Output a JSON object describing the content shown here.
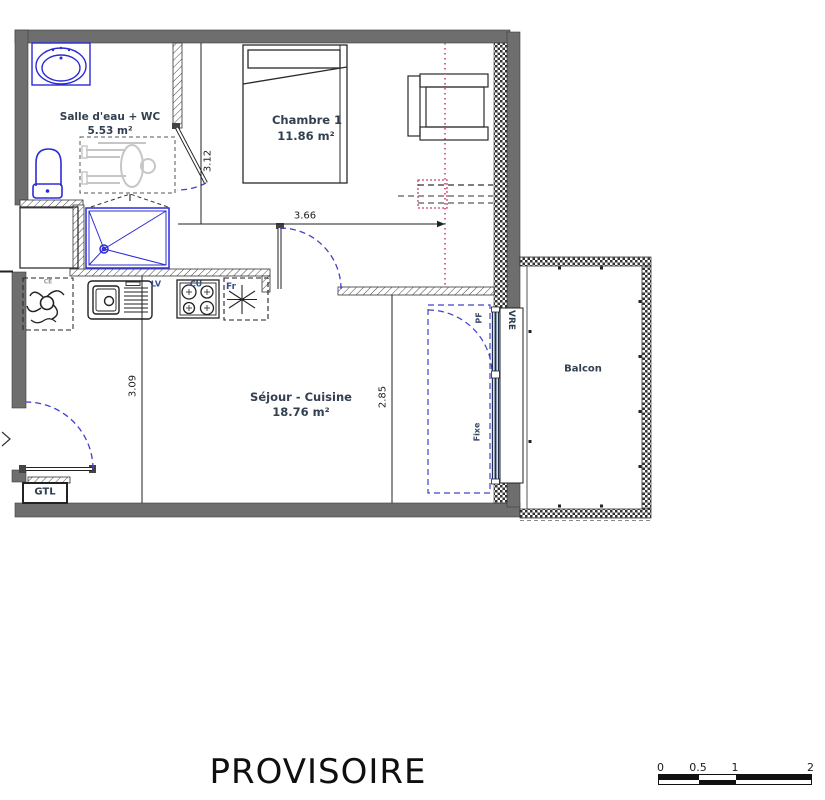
{
  "colors": {
    "wall_gray": "#6e6e6e",
    "fixture_blue": "#2b2bd5",
    "door_arc_blue": "#4040cc",
    "section_red": "#c2486a",
    "room_label": "#32404f",
    "appliance_label_blue": "#33508c"
  },
  "rooms": {
    "bathroom": {
      "name": "Salle d'eau + WC",
      "area": "5.53 m²"
    },
    "bedroom": {
      "name": "Chambre 1",
      "area": "11.86 m²"
    },
    "living": {
      "name": "Séjour - Cuisine",
      "area": "18.76 m²"
    },
    "balcony": {
      "name": "Balcon"
    }
  },
  "dimensions": {
    "bathroom_wall": "3.12",
    "bedroom_width": "3.66",
    "living_left": "3.09",
    "living_right": "2.85"
  },
  "annotations": {
    "gtl": "GTL",
    "water_heater": "CE",
    "sink_unit": "LV",
    "cooktop": "CU",
    "fridge": "Fr",
    "french_window": "PF",
    "fixed_pane": "Fixe",
    "roller_shutter": "VRE"
  },
  "footer": {
    "title": "PROVISOIRE"
  },
  "scalebar": {
    "tick0": "0",
    "tick05": "0.5",
    "tick1": "1",
    "tick2": "2"
  }
}
